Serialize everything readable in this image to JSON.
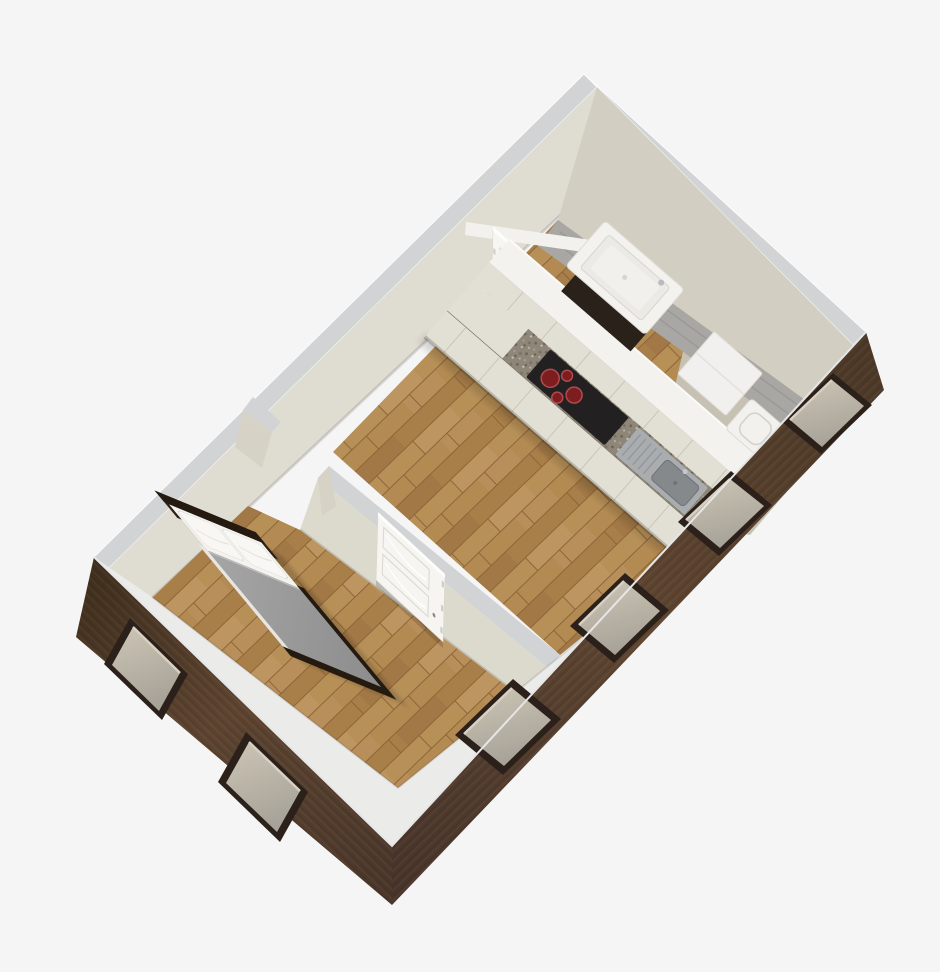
{
  "meta": {
    "title": "3D isometric floor-plan rendering of a one-bedroom apartment (dollhouse cutaway view)",
    "render_style": "top-down oblique architectural render, no visible text"
  },
  "palette": {
    "background": "#f5f5f6",
    "wallTop": "#d2d3d5",
    "wallFaceNW": "#dfdcd1",
    "wallFaceNE": "#d2cfc2",
    "wallFacePartition": "#dcd9cd",
    "wallFaceJamb": "#d6d3c6",
    "whiteBand": "#ebebe9",
    "walkway": "#a8a7a4",
    "tanFloor": "#c6c1b2",
    "woodBase": "#b08855",
    "brownDark": "#46331f",
    "brownMid": "#5d4430",
    "windowFrame": "#2b211a",
    "windowGlass": "#b7b2a7",
    "windowSill": "#d8d1c3",
    "doorWhite": "#f6f5f2",
    "doorPanelLine": "#dcdad2",
    "lintelWhite": "#f2f1ed",
    "counterWhite": "#f3f2ef",
    "cabinetCream": "#e2dfd4",
    "cabinetSeam": "#c9c5b8",
    "granite": "#8e8678",
    "cooktopBlack": "#222021",
    "burnerRed": "#7e1d20",
    "burnerRing": "#b04a4e",
    "steel": "#a9adb0",
    "steelBasin": "#85898c",
    "bedHeadboard": "#2e2217",
    "bedFrame": "#241a10",
    "sheetWhite": "#f3f2ee",
    "pillowWhite": "#f8f7f4",
    "duvetGray": "#9a9a9a",
    "basinWhite": "#f3f2ef",
    "basinBase": "#2a211a",
    "fridgeWhite": "#f1f0ee",
    "toiletWhite": "#f2f1ee"
  },
  "scene": {
    "walls": {
      "exterior_finish": "dark walnut wood panelling",
      "interior_finish": "cream plaster with light gray wall tops",
      "partition": "cream partition with open doorway near north-west wall"
    },
    "rooms": [
      {
        "name": "bedroom",
        "floor": "hardwood planks",
        "windows": 3,
        "doors": 1,
        "furniture": [
          {
            "name": "double-bed",
            "details": [
              "dark wood headboard",
              "two white pillows",
              "white folded sheet",
              "gray duvet",
              "dark wood foot frame"
            ]
          }
        ]
      },
      {
        "name": "kitchen-living-room",
        "floor": "hardwood planks with light utility strip along far wall",
        "windows": 3,
        "doors": 1,
        "fixtures": [
          {
            "name": "kitchen-counter",
            "details": [
              "white back counter",
              "speckled granite worktop",
              "cream cabinet fronts"
            ]
          },
          {
            "name": "cooktop",
            "burners": 4,
            "details": [
              "black glass surface",
              "red burner rings"
            ]
          },
          {
            "name": "counter-sink",
            "details": [
              "stainless steel",
              "drainboard grooves",
              "faucet"
            ]
          },
          {
            "name": "washbasin",
            "details": [
              "white basin on dark wood base"
            ]
          },
          {
            "name": "refrigerator",
            "details": [
              "white, top view"
            ]
          },
          {
            "name": "toilet",
            "details": [
              "white, top view"
            ]
          }
        ]
      }
    ]
  }
}
